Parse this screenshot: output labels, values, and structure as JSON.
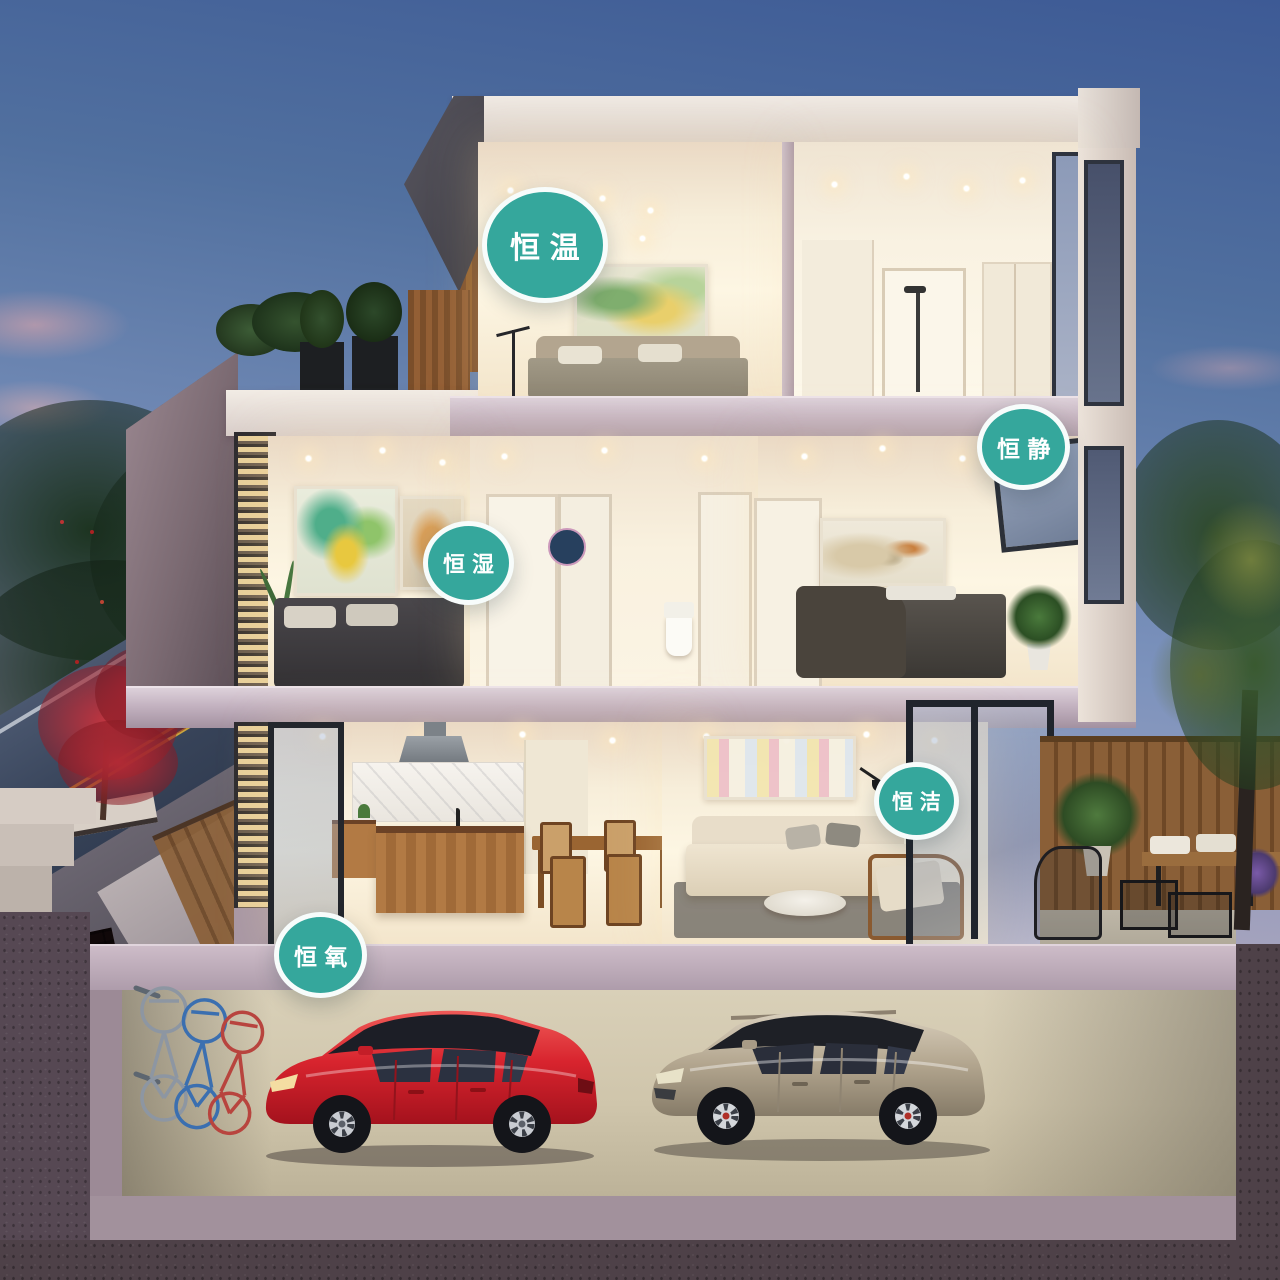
{
  "scene": {
    "description": "Dusk 3D cutaway rendering of a three-storey home with basement garage, two cars, bicycles, street and garden",
    "style": "architectural marketing render"
  },
  "badges": [
    {
      "label": "恒温"
    },
    {
      "label": "恒静"
    },
    {
      "label": "恒湿"
    },
    {
      "label": "恒洁"
    },
    {
      "label": "恒氧"
    }
  ],
  "palette": {
    "badge_teal": "#35a79c",
    "badge_border": "#ffffff",
    "badge_text": "#ffffff",
    "sky_top": "#3d5a95",
    "sky_horizon": "#c9b3bb",
    "slab_mauve": "#c3b2c0",
    "interior_warm": "#f9f1de",
    "facade_taupe": "#7b6a72",
    "asphalt": "#39455b",
    "lane_yellow": "#c9a53e",
    "earth": "#564853",
    "garage_floor": "#cfc5ab",
    "car_red": "#cf232e",
    "car_beige": "#b3a591",
    "foliage_dark": "#21391f",
    "maple_red": "#a82430",
    "wood_fence": "#8a5f37"
  }
}
